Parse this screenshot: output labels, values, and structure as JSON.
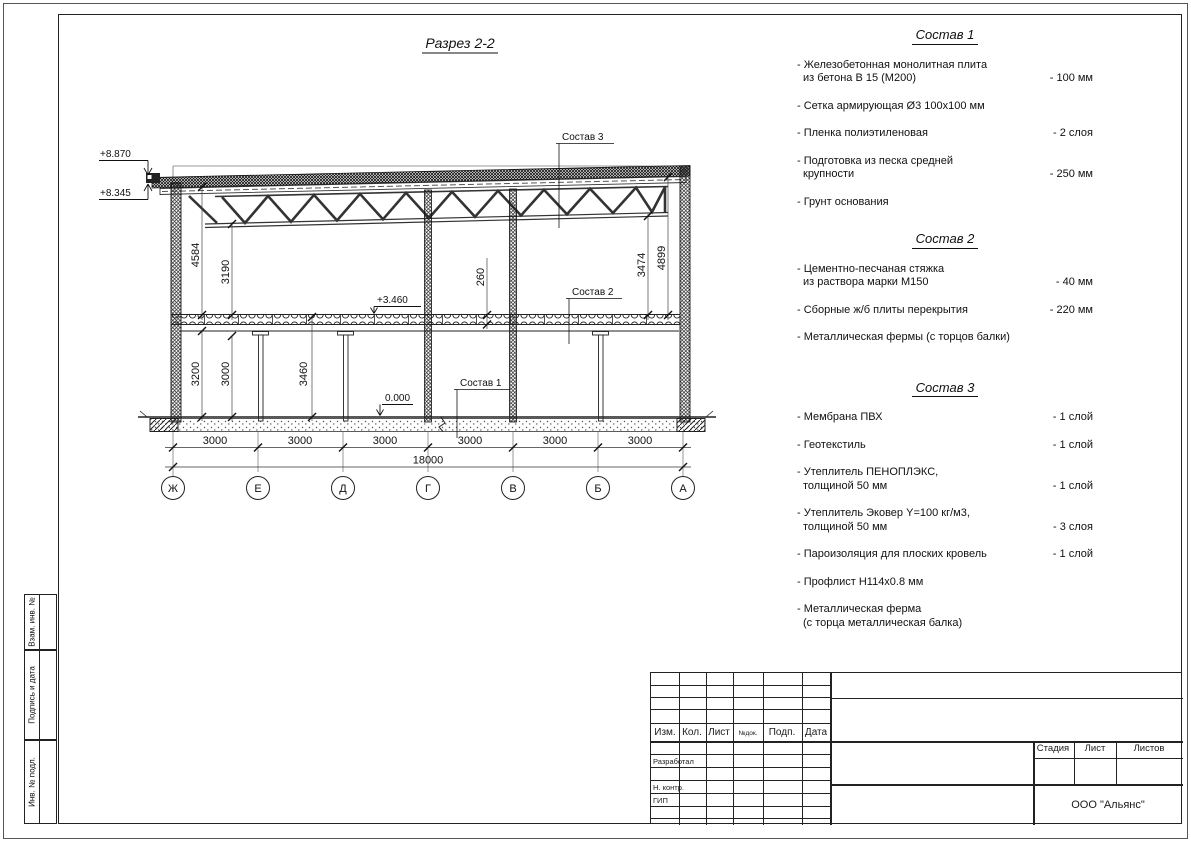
{
  "drawing": {
    "title": "Разрез 2-2",
    "elev_roof_high": "+8.870",
    "elev_roof_low": "+8.345",
    "elev_floor2": "+3.460",
    "elev_zero": "0.000",
    "dim_left_a": "4584",
    "dim_left_b": "3190",
    "dim_low_a": "3200",
    "dim_low_b": "3000",
    "dim_low_c": "3460",
    "dim_slab": "260",
    "dim_right_a": "3474",
    "dim_right_b": "4899",
    "bay": "3000",
    "total": "18000",
    "grid": [
      "Ж",
      "Е",
      "Д",
      "Г",
      "В",
      "Б",
      "А"
    ],
    "callout1": "Состав 1",
    "callout2": "Состав 2",
    "callout3": "Состав 3"
  },
  "compositions": {
    "s1": {
      "heading": "Состав 1",
      "items": [
        {
          "l1": "- Железобетонная монолитная плита",
          "l2": "из бетона В 15 (М200)",
          "val": "- 100 мм"
        },
        {
          "l1": "- Сетка армирующая Ø3 100х100 мм"
        },
        {
          "l1": "- Пленка полиэтиленовая",
          "val": "-  2 слоя"
        },
        {
          "l1": "- Подготовка из песка средней",
          "l2": "крупности",
          "val": "- 250 мм"
        },
        {
          "l1": "- Грунт основания"
        }
      ]
    },
    "s2": {
      "heading": "Состав 2",
      "items": [
        {
          "l1": "- Цементно-песчаная стяжка",
          "l2": "из раствора марки М150",
          "val": "- 40 мм"
        },
        {
          "l1": "- Сборные ж/б плиты перекрытия",
          "val": "- 220 мм"
        },
        {
          "l1": "- Металлическая фермы (с торцов балки)"
        }
      ]
    },
    "s3": {
      "heading": "Состав 3",
      "items": [
        {
          "l1": "- Мембрана ПВХ",
          "val": "- 1 слой"
        },
        {
          "l1": "- Геотекстиль",
          "val": "- 1 слой"
        },
        {
          "l1": "- Утеплитель ПЕНОПЛЭКС,",
          "l2": "толщиной 50 мм",
          "val": "- 1 слой"
        },
        {
          "l1": "- Утеплитель Эковер Y=100 кг/м3,",
          "l2": "толщиной 50 мм",
          "val": "- 3 слоя"
        },
        {
          "l1": "- Пароизоляция для плоских кровель",
          "val": "- 1 слой"
        },
        {
          "l1": "- Профлист Н114х0.8 мм"
        },
        {
          "l1": "- Металлическая ферма",
          "l2": "(с торца металлическая балка)"
        }
      ]
    }
  },
  "sidebar": {
    "labels": [
      "Взам. инв. №",
      "Подпись и дата",
      "Инв. № подл."
    ]
  },
  "titleblock": {
    "header_cols": [
      "Изм.",
      "Кол.",
      "Лист",
      "№док.",
      "Подп.",
      "Дата"
    ],
    "row_labels": [
      "Разработал",
      "Н. контр.",
      "ГИП"
    ],
    "stage_cols": [
      "Стадия",
      "Лист",
      "Листов"
    ],
    "company": "ООО \"Альянс\""
  }
}
